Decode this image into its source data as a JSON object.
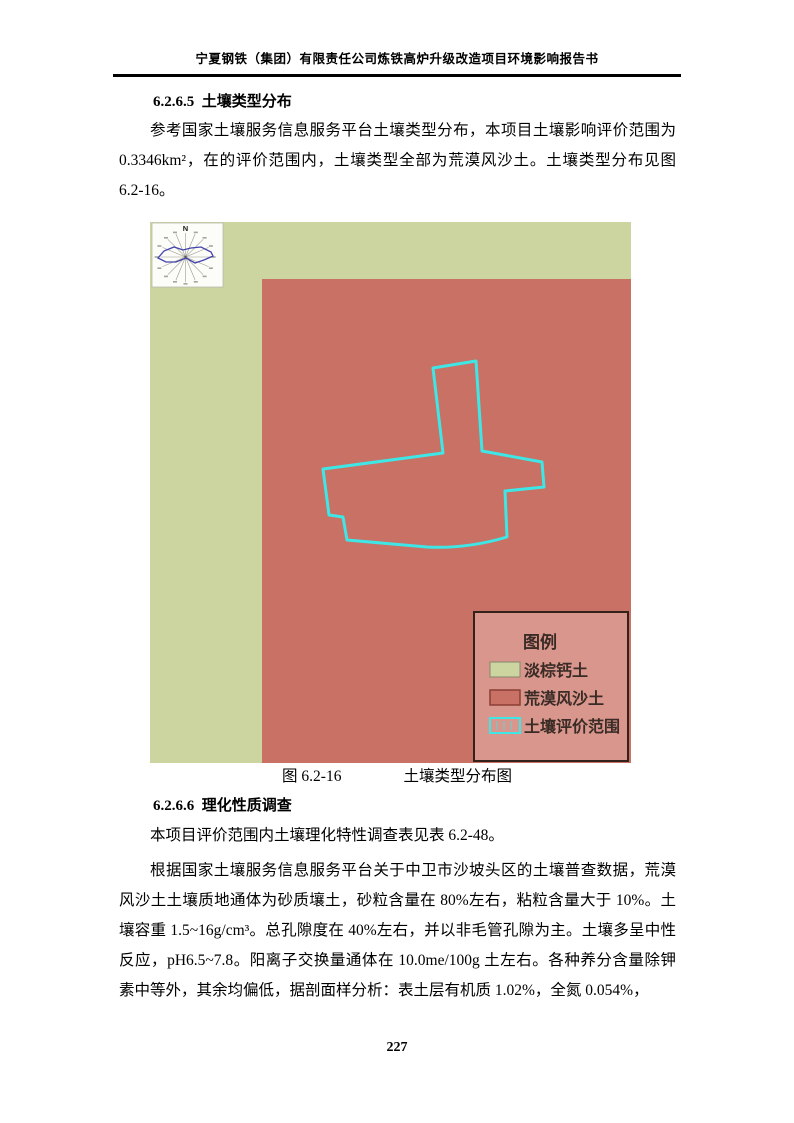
{
  "header": {
    "title": "宁夏钢铁（集团）有限责任公司炼铁高炉升级改造项目环境影响报告书"
  },
  "section_1": {
    "heading": "6.2.6.5  土壤类型分布",
    "paragraph": "参考国家土壤服务信息服务平台土壤类型分布，本项目土壤影响评价范围为 0.3346km²，在的评价范围内，土壤类型全部为荒漠风沙土。土壤类型分布见图 6.2-16。"
  },
  "figure": {
    "compass": {
      "north_label": "N"
    },
    "legend": {
      "title": "图例",
      "items": [
        {
          "label": "淡棕钙土",
          "swatch": "green-fill"
        },
        {
          "label": "荒漠风沙土",
          "swatch": "red-fill"
        },
        {
          "label": "土壤评价范围",
          "swatch": "cyan-outline"
        }
      ]
    },
    "caption_label": "图 6.2-16",
    "caption_title": "土壤类型分布图",
    "colors": {
      "light_brown_calcium_soil": "#ccd5a0",
      "desert_wind_sand_soil": "#c87164",
      "soil_evaluation_boundary": "#3fe6e6",
      "legend_background": "#d9968c",
      "legend_border": "#33211c",
      "legend_text": "#3a2b26",
      "wind_rose_outline": "#4343ad"
    }
  },
  "section_2": {
    "heading": "6.2.6.6  理化性质调查",
    "paragraph_1": "本项目评价范围内土壤理化特性调查表见表 6.2-48。",
    "paragraph_2": "根据国家土壤服务信息服务平台关于中卫市沙坡头区的土壤普查数据，荒漠风沙土土壤质地通体为砂质壤土，砂粒含量在 80%左右，粘粒含量大于 10%。土壤容重 1.5~16g/cm³。总孔隙度在 40%左右，并以非毛管孔隙为主。土壤多呈中性反应，pH6.5~7.8。阳离子交换量通体在 10.0me/100g 土左右。各种养分含量除钾素中等外，其余均偏低，据剖面样分析：表土层有机质 1.02%，全氮 0.054%，"
  },
  "footer": {
    "page_number": "227"
  }
}
